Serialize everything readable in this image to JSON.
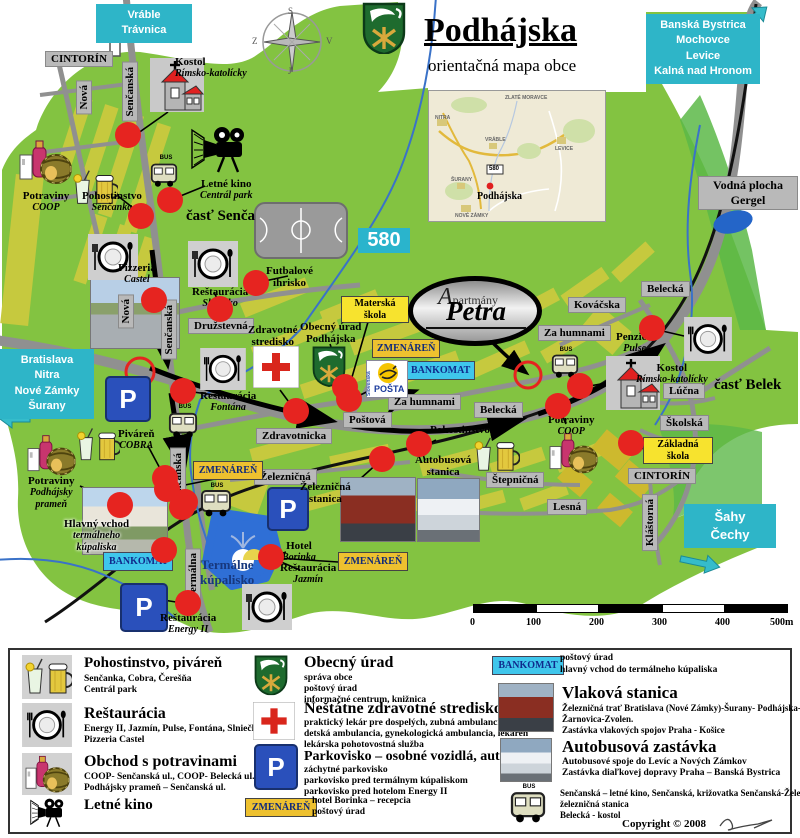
{
  "header": {
    "title": "Podhájska",
    "subtitle": "orientačná mapa obce"
  },
  "compass": {
    "n": "S",
    "e": "V",
    "s": "J",
    "w": "Z"
  },
  "signs": {
    "vrable": [
      "Vráble",
      "Trávnica"
    ],
    "banska": [
      "Banská Bystrica",
      "Mochovce",
      "Levice",
      "Kalná nad Hronom"
    ],
    "bratislava": [
      "Bratislava",
      "Nitra",
      "Nové Zámky",
      "Šurany"
    ],
    "sahy": [
      "Šahy",
      "Čechy"
    ],
    "road580": "580",
    "bankomat": "BANKOMAT",
    "zmenaren": "ZMENÁREŇ",
    "posta": "POŠTA",
    "posta_side": "Slovenská",
    "bus": "BUS"
  },
  "streets": {
    "cintorin": "CINTORÍN",
    "nova": "Nová",
    "sencanska": "Senčanská",
    "druzstevna": "Družstevná",
    "zdravotnicka": "Zdravotnicka",
    "postova": "Poštová",
    "za_humnami": "Za humnami",
    "belecka": "Belecká",
    "kovacska": "Kováčska",
    "lucna": "Lúčna",
    "skolska": "Školská",
    "stepnicna": "Štepničná",
    "lesna": "Lesná",
    "klastorna": "Kláštorná",
    "zeleznicna": "Železničná",
    "termalna": "Termálna"
  },
  "areas": {
    "senca": "časť Senča",
    "belek": "časť Belek",
    "gergel": [
      "Vodná plocha",
      "Gergel"
    ]
  },
  "pois": {
    "kostol": {
      "t": "Kostol",
      "s": "Rímsko-katolícky"
    },
    "potraviny_coop": {
      "t": "Potraviny",
      "s": "COOP"
    },
    "pohostinstvo_sencanka": {
      "t": "Pohostinstvo",
      "s": "Senčanka"
    },
    "letne_kino": {
      "t": "Letné kino",
      "s": "Centrál park"
    },
    "pizzeria": {
      "t": "Pizzeria",
      "s": "Castel"
    },
    "rest_slniecko": {
      "t": "Reštaurácia",
      "s": "Slniečko"
    },
    "futbal": [
      "Futbalové",
      "ihrisko"
    ],
    "zdravotne": [
      "Zdravotné",
      "stredisko"
    ],
    "obecny": [
      "Obecný úrad",
      "Podhájska"
    ],
    "materska": [
      "Materská",
      "škola"
    ],
    "zakladna": [
      "Základná",
      "škola"
    ],
    "rest_fontana": {
      "t": "Reštaurácia",
      "s": "Fontána"
    },
    "pivaren_cobra": {
      "t": "Piváreň",
      "s": "COBRA"
    },
    "potraviny_pramen": {
      "t": "Potraviny",
      "s1": "Podhájsky",
      "s2": "prameň"
    },
    "penzion": {
      "t": "Penzión",
      "s": "Pulse"
    },
    "pohost_ceresna": {
      "t": "Pohostinstvo",
      "s": "Čerešňa"
    },
    "zel_stanica": [
      "Železničná",
      "stanica"
    ],
    "aut_stanica": [
      "Autobusová",
      "stanica"
    ],
    "hlavny_vchod": {
      "t": "Hlavný vchod",
      "s1": "termálneho",
      "s2": "kúpaliska"
    },
    "termalne": [
      "Termálne",
      "kúpalisko"
    ],
    "hotel_borinka": {
      "t": "Hotel",
      "s": "Borinka"
    },
    "rest_jazmin": {
      "t": "Reštaurácia",
      "s": "Jazmín"
    },
    "rest_energy": {
      "t": "Reštaurácia",
      "s": "Energy II"
    },
    "petra": {
      "line1": "Apartmány",
      "name": "Petra"
    }
  },
  "inset": {
    "towns": [
      "ZLATÉ MORAVCE",
      "NITRA",
      "VRÁBLE",
      "LEVICE",
      "ŠURANY",
      "NOVÉ ZÁMKY"
    ],
    "place": "Podhájska",
    "road": "580"
  },
  "scalebar": [
    "0",
    "100",
    "200",
    "300",
    "400",
    "500m"
  ],
  "legend": {
    "pohostinstvo": {
      "title": "Pohostinstvo, piváreň",
      "l1": "Senčanka, Cobra, Čerešňa",
      "l2": "Centrál park"
    },
    "restauracia": {
      "title": "Reštaurácia",
      "l1": "Energy II, Jazmín, Pulse, Fontána, Slniečko",
      "l2": "Pizzeria Castel"
    },
    "obchod": {
      "title": "Obchod s potravinami",
      "l1": "COOP- Senčanská ul., COOP- Belecká ul.",
      "l2": "Podhájsky prameň – Senčanská ul."
    },
    "kino": {
      "title": "Letné kino"
    },
    "obecny": {
      "title": "Obecný úrad",
      "l1": "správa obce",
      "l2": "poštový úrad",
      "l3": "informačné centrum, knižnica"
    },
    "zdravotne": {
      "title": "Neštátne zdravotné stredisko",
      "l1": "praktický lekár pre dospelých, zubná ambulancia",
      "l2": "detská ambulancia, gynekologická ambulancia, lekáreň",
      "l3": "lekárska pohotovostná služba"
    },
    "parkovisko": {
      "title": "Parkovisko – osobné vozidlá, autobusy",
      "l1": "záchytné parkovisko",
      "l2": "parkovisko pred termálnym kúpaliskom",
      "l3": "parkovisko pred hotelom Energy II"
    },
    "zmenaren": {
      "l1": "hotel Borinka – recepcia",
      "l2": "poštový úrad"
    },
    "bankomat": {
      "l1": "poštový úrad",
      "l2": "hlavný vchod do termálneho kúpaliska"
    },
    "vlak": {
      "title": "Vlaková stanica",
      "l1": "Železničná trať Bratislava (Nové Zámky)-Šurany- Podhájska-Levice-",
      "l2": "Žarnovica-Zvolen.",
      "l3": "Zastávka vlakových spojov Praha - Košice"
    },
    "autobus": {
      "title": "Autobusová zastávka",
      "l1": "Autobusové spoje do Levíc a Nových Zámkov",
      "l2": "Zastávka diaľkovej dopravy Praha – Banská Bystrica"
    },
    "bus_stops": {
      "l1": "Senčanská – letné kino, Senčanská, križovatka Senčanská-Železničná",
      "l2": "železničná stanica",
      "l3": "Belecká - kostol"
    }
  },
  "copyright": "Copyright © 2008"
}
